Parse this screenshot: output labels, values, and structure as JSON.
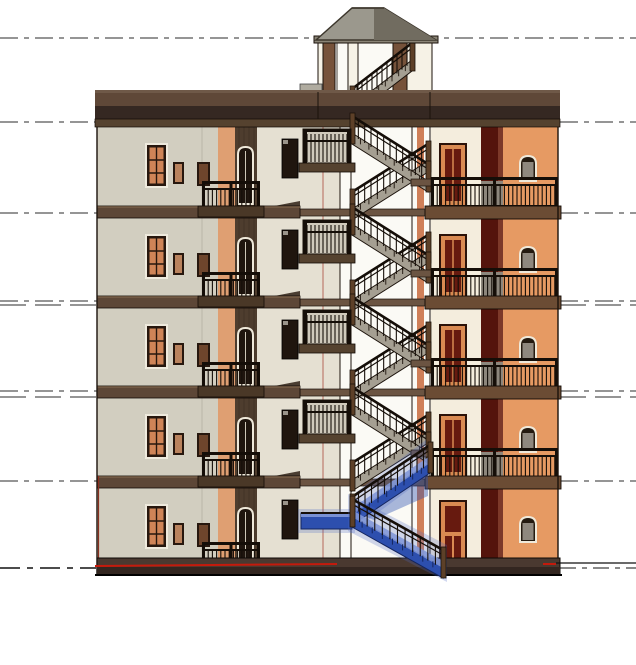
{
  "view": {
    "width": 636,
    "height": 665,
    "background": "#ffffff",
    "description": "3D section-elevation of a 5-storey apartment building with central stair tower; ground-floor stair run selected (blue)"
  },
  "palette": {
    "line": "#2b2b2b",
    "outline": "#1b120b",
    "wallLeft": "#d2cec0",
    "wallCream": "#e5e0d2",
    "wallWhite": "#fbfaf5",
    "stripeOrange": "#df9f72",
    "stripeDark": "#4e3d2e",
    "cutOrange": "#cf7f58",
    "corniceHi": "#6f5948",
    "corniceTop": "#5f4838",
    "corniceBottom": "#352822",
    "ledge": "#55422f",
    "band": "#5d4737",
    "bandHi": "#7a6148",
    "bandRight": "#6b4c34",
    "soffit": "#392b1f",
    "slabDark": "#4a3827",
    "stairBandFill": "#6b5442",
    "base": "#4a3930",
    "baseDark": "#332620",
    "frame": "#27170e",
    "trim": "#efeadd",
    "glassOrange": "#cf8457",
    "glassSmall": "#b9825d",
    "glassMed": "#6e452c",
    "glassGray": "#8f887e",
    "winDark": "#1f150e",
    "glint": "#9a948a",
    "archLight": "#efe9da",
    "archInner": "#241a10",
    "doorRed": "#671a0f",
    "doorFrame": "#d98a52",
    "doorEdge": "#2b1209",
    "maroon": "#54140c",
    "maroonLight": "#7c3929",
    "wallOrange": "#e69a63",
    "creamRight": "#f4eddd",
    "rail": "#150e08",
    "railPost": "#5d4028",
    "railPanel": "#8d867c",
    "stairBand": "#a59f92",
    "landing": "#cfc9bb",
    "stepTick": "#2a2018",
    "towerPost": "#76523a",
    "towerLight": "#f6f2e6",
    "towerInner": "#fbfaf5",
    "beam": "#8a8476",
    "roofLight": "#9b988d",
    "roofDark": "#716c60",
    "roofEdge": "#3c362c",
    "parapet": "#b0aca0",
    "seam": "#bab6a8",
    "pinkEdge": "#b5685a",
    "redEdge": "#8a3020",
    "selBlue": "#2d4fae",
    "selLight": "#8298d8",
    "selGlow": "#4a66c4",
    "selDark": "#14255e",
    "red": "#c41a0c",
    "ground": "#111111"
  },
  "levels": {
    "ys": [
      38,
      122,
      213,
      301,
      391,
      481
    ],
    "extra": [
      305,
      397
    ],
    "dash": "18 6 5 6",
    "extraDash": "26 9",
    "groundSolidLeft": {
      "x1": 0,
      "y1": 568,
      "x2": 96,
      "y2": 568,
      "dash": "20 7 6 7"
    },
    "groundSolidRight": {
      "x1": 556,
      "y1": 563,
      "x2": 636,
      "y2": 563
    },
    "groundDashRight": {
      "x1": 560,
      "y1": 568,
      "x2": 636,
      "y2": 568,
      "dash": "16 6 5 6"
    },
    "redLine": {
      "x1": 95,
      "y1": 566,
      "x2": 337,
      "y2": 564
    },
    "redLine2": {
      "x1": 543,
      "y1": 564,
      "x2": 556,
      "y2": 564
    }
  },
  "building": {
    "left": 97,
    "right": 558,
    "wallTop": 127,
    "baseTop": 558,
    "baseBottom": 575,
    "stories": [
      127,
      218,
      308,
      398,
      488
    ],
    "bands": [
      206,
      296,
      386,
      476
    ],
    "cornice": {
      "x": 95,
      "w": 465,
      "seams": [
        318,
        430
      ],
      "parapet": [
        300,
        84,
        22,
        8
      ]
    },
    "leftBlock": {
      "x": 97,
      "w": 160,
      "seamX": 202,
      "stripeOrange": [
        218,
        17
      ],
      "stripeDark": [
        235,
        22
      ],
      "tall": [
        147,
        18,
        19,
        41
      ],
      "small": [
        173,
        35,
        11,
        22
      ],
      "med": [
        197,
        35,
        13,
        24
      ],
      "darkWin": [
        282,
        12,
        16,
        39
      ],
      "arch": [
        238,
        20,
        15,
        57
      ],
      "balcony": {
        "x": 202,
        "w": 58,
        "dy": 54,
        "h": 30
      },
      "slab": [
        198,
        66
      ]
    },
    "stairwell": {
      "creamX": 257,
      "creamW": 83,
      "voidX": 340,
      "voidW": 91,
      "cutLines": [
        340,
        351,
        412,
        430
      ],
      "orangeStrip": [
        417,
        7
      ],
      "pinkLineX": 323
    },
    "rightBlock": {
      "creamX": 431,
      "creamW": 50,
      "maroonX": 481,
      "maroonW": 22,
      "orangeX": 503,
      "orangeW": 55,
      "door": [
        441,
        18,
        24,
        60
      ],
      "doorGround": [
        441,
        14,
        24,
        61
      ],
      "arch": [
        520,
        29,
        16,
        25
      ],
      "balcony": {
        "x": 431,
        "w": 127,
        "dy": 50,
        "h": 30,
        "panel": [
          481,
          22
        ]
      },
      "bandX": 425,
      "bandW": 136
    }
  },
  "tower": {
    "inner": [
      337,
      42,
      56,
      51
    ],
    "posts": [
      [
        318,
        5,
        "light"
      ],
      [
        323,
        12,
        "dark"
      ],
      [
        348,
        10,
        "light"
      ],
      [
        393,
        14,
        "dark"
      ],
      [
        407,
        25,
        "light"
      ]
    ],
    "postTop": 42,
    "postHeight": 53,
    "eave": [
      314,
      36,
      124,
      7
    ],
    "roof": [
      [
        316,
        40
      ],
      [
        352,
        8
      ],
      [
        384,
        8
      ],
      [
        436,
        40
      ]
    ],
    "roofRight": [
      [
        374,
        9
      ],
      [
        384,
        8
      ],
      [
        436,
        40
      ],
      [
        374,
        40
      ]
    ],
    "flight": [
      412,
      60,
      352,
      106
    ]
  },
  "stairs": {
    "flightLR": [
      352,
      6,
      428,
      54
    ],
    "flightRL": [
      428,
      34,
      352,
      82
    ],
    "midSlab": [
      411,
      52,
      20,
      7
    ],
    "landing": [
      303,
      2,
      48,
      34
    ],
    "landingSlab": [
      299,
      36,
      56,
      9
    ],
    "ground": {
      "flightA": [
        430,
        462,
        352,
        514
      ],
      "landing": [
        301,
        513,
        51,
        16
      ],
      "flightB": [
        352,
        516,
        443,
        567
      ],
      "wedge": [
        [
          354,
          512
        ],
        [
          428,
          466
        ],
        [
          428,
          496
        ],
        [
          374,
          520
        ]
      ]
    }
  }
}
